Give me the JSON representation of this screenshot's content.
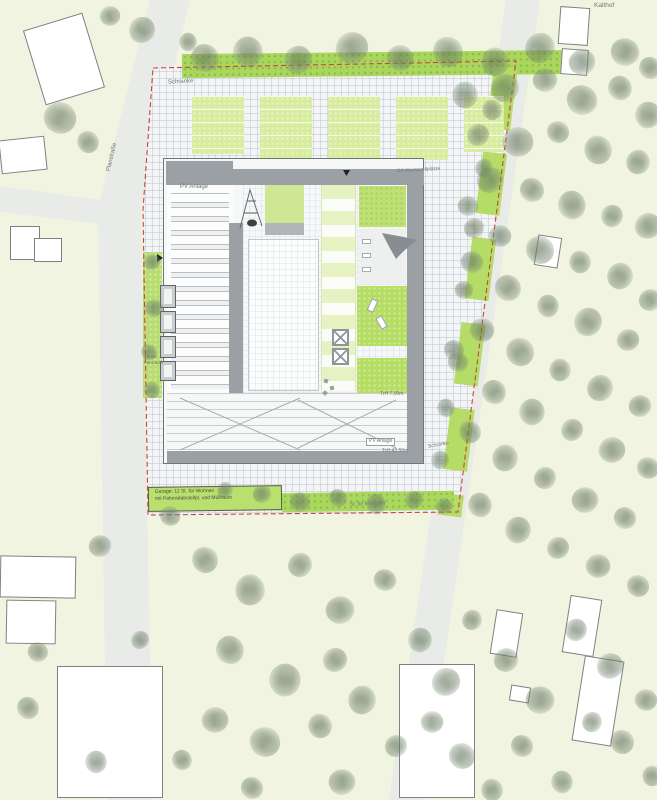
{
  "plan": {
    "title": "Lageplan Feuerwache mit Wohnhof",
    "labels": {
      "barrier_top": "Schranke",
      "street_left": "Planstraße",
      "district_top_right": "Kalthof",
      "pv_left_wing": "PV Anlage",
      "alarm_parking": "110 Alarmstellplätze",
      "eave_courtyard": "TrH 7,00m",
      "pv_bottom_wing": "PV Anlage",
      "eave_south": "TrH 43,50m",
      "barrier_right": "Schranke",
      "garage_line1": "Garage: 11 St. für Wohnen",
      "garage_line2": "mit Fahrradabstellpl. und Müllraum",
      "visitor_parking": "St. für Besucher",
      "bike_count_line1": "34 Stk",
      "bike_count_line2": "Fahrräder"
    },
    "colors": {
      "background": "#f1f4e1",
      "road": "#e8ebe7",
      "paving": "#f3f4f6",
      "grid_line": "#e1e5e9",
      "roof_dark": "#9aa0a4",
      "lawn_light": "#cfe795",
      "lawn_bright": "#b5dd63",
      "hedge": "#a9d65c",
      "parking_bay": "#d7ec9e",
      "boundary_red": "#c9453a",
      "building_outline": "#6e7678",
      "context_building": "#ffffff"
    },
    "icons": {
      "tree": "css-blob",
      "shade_sail": "svg-curved-triangle",
      "play_structure": "svg-frame-lines",
      "lounger": "white-rect",
      "bench": "white-rect",
      "skylight_cross": "x-square",
      "entrance_arrow": "black-triangle"
    }
  }
}
